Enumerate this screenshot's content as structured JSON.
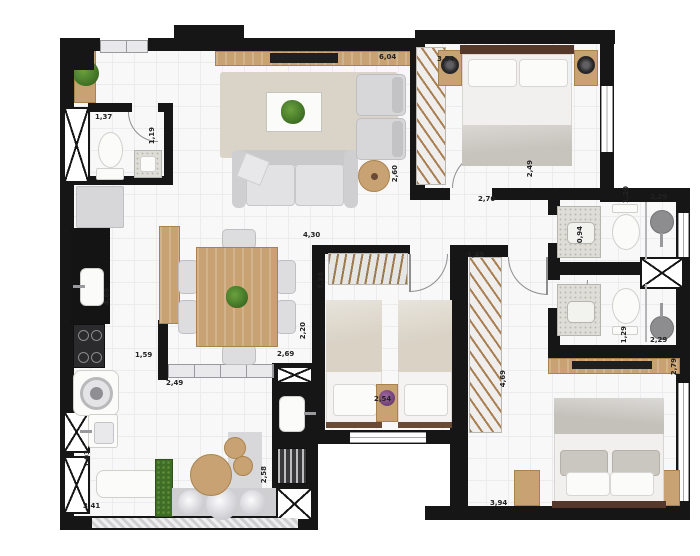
{
  "figure": {
    "type": "apartment-floor-plan",
    "units": "meters",
    "decimal_separator": "comma"
  },
  "dims": {
    "lavabo_width": "1,37",
    "lavabo_depth": "1,19",
    "living_width": "6,04",
    "dorm2_width": "3,54",
    "living_depth": "2,60",
    "dorm2_door": "2,70",
    "dorm2_window": "2,49",
    "bath1_depth": "1,20",
    "bath1_width": "2,29",
    "hall_width": "0,94",
    "dorm3_width": "4,30",
    "dorm3_depth": "3,24",
    "corridor": "2,20",
    "closet_width": "1,49",
    "kitchen_depth": "4,69",
    "kitchen_wall": "1,59",
    "balcony_door": "2,49",
    "gourmet_width": "2,69",
    "dorm3_beds": "2,54",
    "service_depth": "1,03",
    "balcony_width": "3,41",
    "gourmet_depth": "2,58",
    "bath2_depth": "1,29",
    "bath2_width": "2,29",
    "suite_side": "2,79",
    "suite_depth": "4,69",
    "suite_width": "3,94"
  },
  "colors": {
    "wall": "#161616",
    "floor": "#f8f8f9",
    "floor_grid": "#ececef",
    "wood": "#c8a272",
    "wood_dark": "#55382a",
    "rug": "#d9d3c8",
    "upholstery": "#d7d7d9",
    "bedding_white": "#f1f0ee",
    "blanket_gray": "#c4c1bb",
    "blanket_beige": "#d9d2c5",
    "plant_green": "#4e7e2c",
    "hedge_green": "#3f6d26",
    "flower_purple": "#7a4a7e",
    "counter_black": "#141414",
    "granite": "#deddd7"
  }
}
